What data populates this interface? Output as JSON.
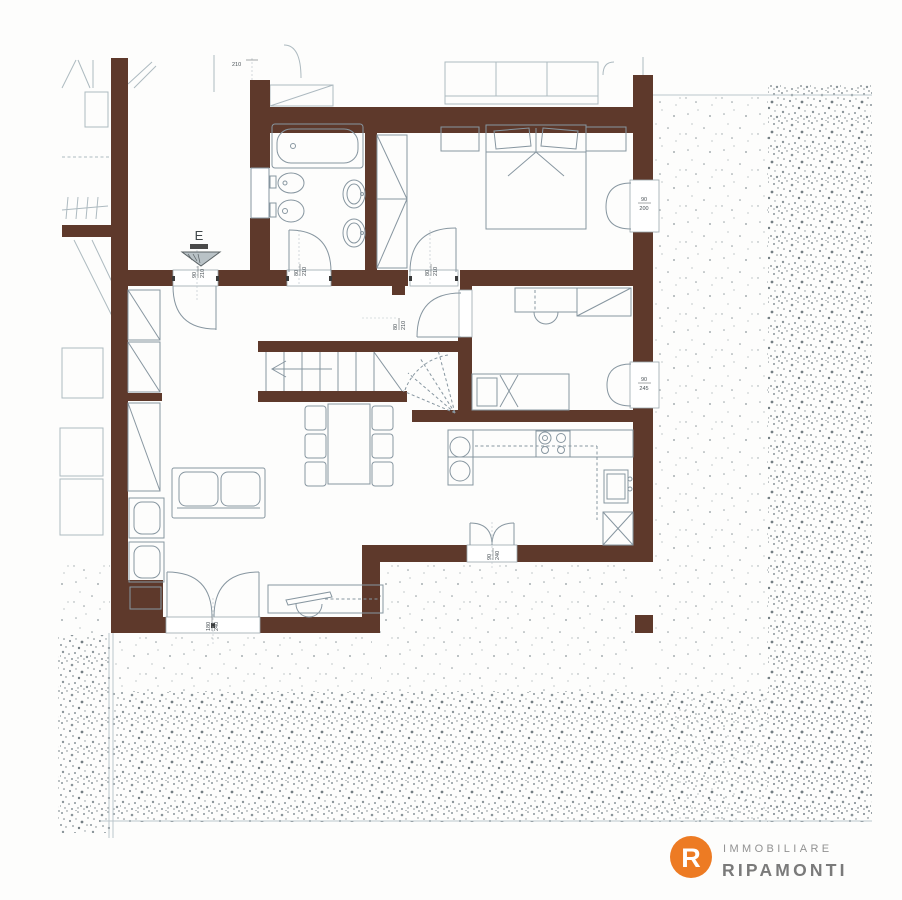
{
  "plan": {
    "top_dimension": "210",
    "entrance_marker": "E",
    "doors": {
      "entry": {
        "w": "90",
        "h": "210"
      },
      "bathroom": {
        "w": "80",
        "h": "210"
      },
      "bedroom1": {
        "w": "80",
        "h": "210"
      },
      "bedroom2": {
        "w": "80",
        "h": "210"
      },
      "kitchen": {
        "w": "90",
        "h": "240"
      },
      "living_french": {
        "w": "180",
        "h": "240"
      }
    },
    "windows": {
      "bedroom1": {
        "w": "90",
        "h": "200"
      },
      "bedroom2": {
        "w": "90",
        "h": "245"
      }
    }
  },
  "logo": {
    "monogram": "R",
    "line1": "IMMOBILIARE",
    "line2": "RIPAMONTI"
  },
  "colors": {
    "wall": "#5E392B",
    "furniture_line": "#8796A0",
    "context_line": "#ADBAC0",
    "stipple": "#8E989C",
    "label": "#4A5257",
    "logo_orange": "#ED7B23",
    "logo_gray": "#8E8E8E"
  }
}
